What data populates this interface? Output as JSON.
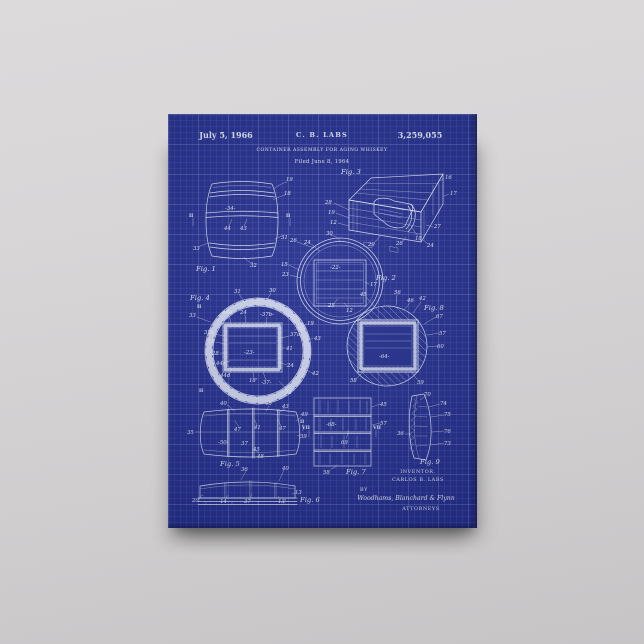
{
  "artwork": {
    "header": {
      "date": "July 5, 1966",
      "assignee": "C. B. LABS",
      "patent_number": "3,259,055",
      "title": "CONTAINER ASSEMBLY FOR AGING WHISKEY",
      "filed": "Filed June 8, 1964"
    },
    "figures": {
      "fig1": {
        "caption": "Fig. 1",
        "refs": {
          "r19": "19",
          "r18": "18",
          "d34": "-34-",
          "r44": "44",
          "r43": "43",
          "r31": "31",
          "r33": "33",
          "r32": "32",
          "sec": "II"
        }
      },
      "fig2": {
        "caption": "Fig. 2",
        "refs": {
          "r30": "30",
          "r26": "26",
          "r24": "24",
          "r15": "15",
          "r23": "23",
          "d22": "-22-",
          "r17": "17",
          "r25": "25",
          "r12": "12"
        }
      },
      "fig3": {
        "caption": "Fig. 3",
        "refs": {
          "r16": "16",
          "r17": "17",
          "r28": "28",
          "r19": "19",
          "r12": "12",
          "r27": "27",
          "r18": "18",
          "r29": "29",
          "r24": "24",
          "r26": "26"
        }
      },
      "fig4": {
        "caption": "Fig. 4",
        "refs": {
          "r31": "31",
          "r30": "30",
          "r33": "33",
          "r44a": "44a",
          "r24": "24",
          "d37b": "-37b-",
          "r19": "19",
          "r37b": "37b",
          "r18": "18",
          "r28": "28",
          "r44c": "44c",
          "d23": "-23-",
          "r41": "41",
          "r37a": "37a",
          "r43": "43",
          "r24b": "24",
          "r44d": "44d",
          "r18p": "18'",
          "d37": "-37-",
          "r42": "42",
          "r32": "32",
          "sec": "II"
        }
      },
      "fig5": {
        "caption": "Fig. 5",
        "refs": {
          "r40": "40",
          "r46": "46",
          "r43": "43",
          "r47a": "47",
          "r41": "41",
          "r47b": "47",
          "d50": "-50-",
          "r37": "37",
          "r45": "45",
          "r48": "48",
          "r35": "35",
          "r49": "49",
          "r39": "39",
          "sec": "II"
        }
      },
      "fig6": {
        "caption": "Fig. 6",
        "refs": {
          "r36": "36",
          "r40": "40",
          "r13": "13",
          "r20p": "20'",
          "r14": "14",
          "r37": "37",
          "r13p": "13'"
        }
      },
      "fig7": {
        "caption": "Fig. 7",
        "refs": {
          "r45": "45",
          "r57": "57",
          "d68": "-68-",
          "r69": "69",
          "r58": "58",
          "sec": "VII"
        }
      },
      "fig8": {
        "caption": "Fig. 8",
        "refs": {
          "r45": "45",
          "r56": "56",
          "r46": "46",
          "r42": "42",
          "r67": "67",
          "r57": "57",
          "r60": "60",
          "d64": "-64-",
          "r59": "59",
          "r58": "58"
        }
      },
      "fig9": {
        "caption": "Fig. 9",
        "refs": {
          "r70": "70",
          "r74": "74",
          "r75": "75",
          "r76": "76",
          "r73": "73",
          "r36": "36"
        }
      }
    },
    "footer": {
      "inventor_label": "INVENTOR.",
      "inventor_name": "CARLOS B. LABS",
      "by_label": "BY",
      "signature": "Woodhams, Blanchard & Flynn",
      "attorneys_label": "ATTORNEYS"
    },
    "colors": {
      "canvas_blue": "#27328f",
      "grid_line": "#4a57b0",
      "ink": "#e9eefb",
      "wall": "#d6d4d5"
    }
  }
}
